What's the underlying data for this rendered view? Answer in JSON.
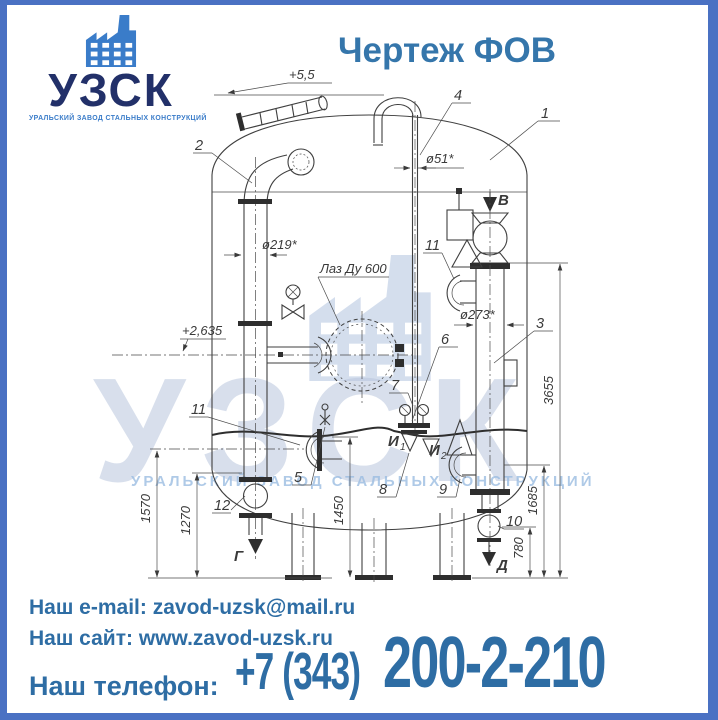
{
  "frame": {
    "border_color": "#4a71c3",
    "background": "#ffffff"
  },
  "logo": {
    "name": "УЗСК",
    "subtitle": "УРАЛЬСКИЙ ЗАВОД СТАЛЬНЫХ КОНСТРУКЦИЙ",
    "icon": "factory-icon",
    "name_color": "#223069",
    "accent_color": "#3a7cc9"
  },
  "title": {
    "text": "Чертеж ФОВ",
    "color": "#3576ab"
  },
  "watermark": {
    "text": "УЗСК",
    "subtext": "УРАЛЬСКИЙ ЗАВОД СТАЛЬНЫХ КОНСТРУКЦИЙ",
    "color": "#b9c6dd"
  },
  "drawing": {
    "elevation_top": "+5,5",
    "elevation_manhole": "+2,635",
    "dia_vent": "ø51*",
    "dia_left_pipe": "ø219*",
    "dia_right_pipe": "ø273*",
    "manhole_label": "Лаз Ду 600",
    "dims": {
      "d3655": "3655",
      "d1685": "1685",
      "d780": "780",
      "d1570": "1570",
      "d1270": "1270",
      "d1450": "1450"
    },
    "callouts": {
      "c1": "1",
      "c2": "2",
      "c3": "3",
      "c4": "4",
      "c5": "5",
      "c6": "6",
      "c7": "7",
      "c8": "8",
      "c9": "9",
      "c10": "10",
      "c11": "11",
      "c11b": "11",
      "c12": "12"
    },
    "sections": {
      "b": "В",
      "g": "Г",
      "d": "Д"
    },
    "internals": {
      "i1": "И",
      "i1_sub": "1",
      "i2": "И",
      "i2_sub": "2"
    }
  },
  "contacts": {
    "email_label": "Наш e-mail:",
    "email_value": "zavod-uzsk@mail.ru",
    "site_label": "Наш сайт:",
    "site_value": "www.zavod-uzsk.ru",
    "phone_label": "Наш телефон:",
    "phone_code": "+7 (343)",
    "phone_number": "200-2-210",
    "color": "#2e6da4"
  }
}
